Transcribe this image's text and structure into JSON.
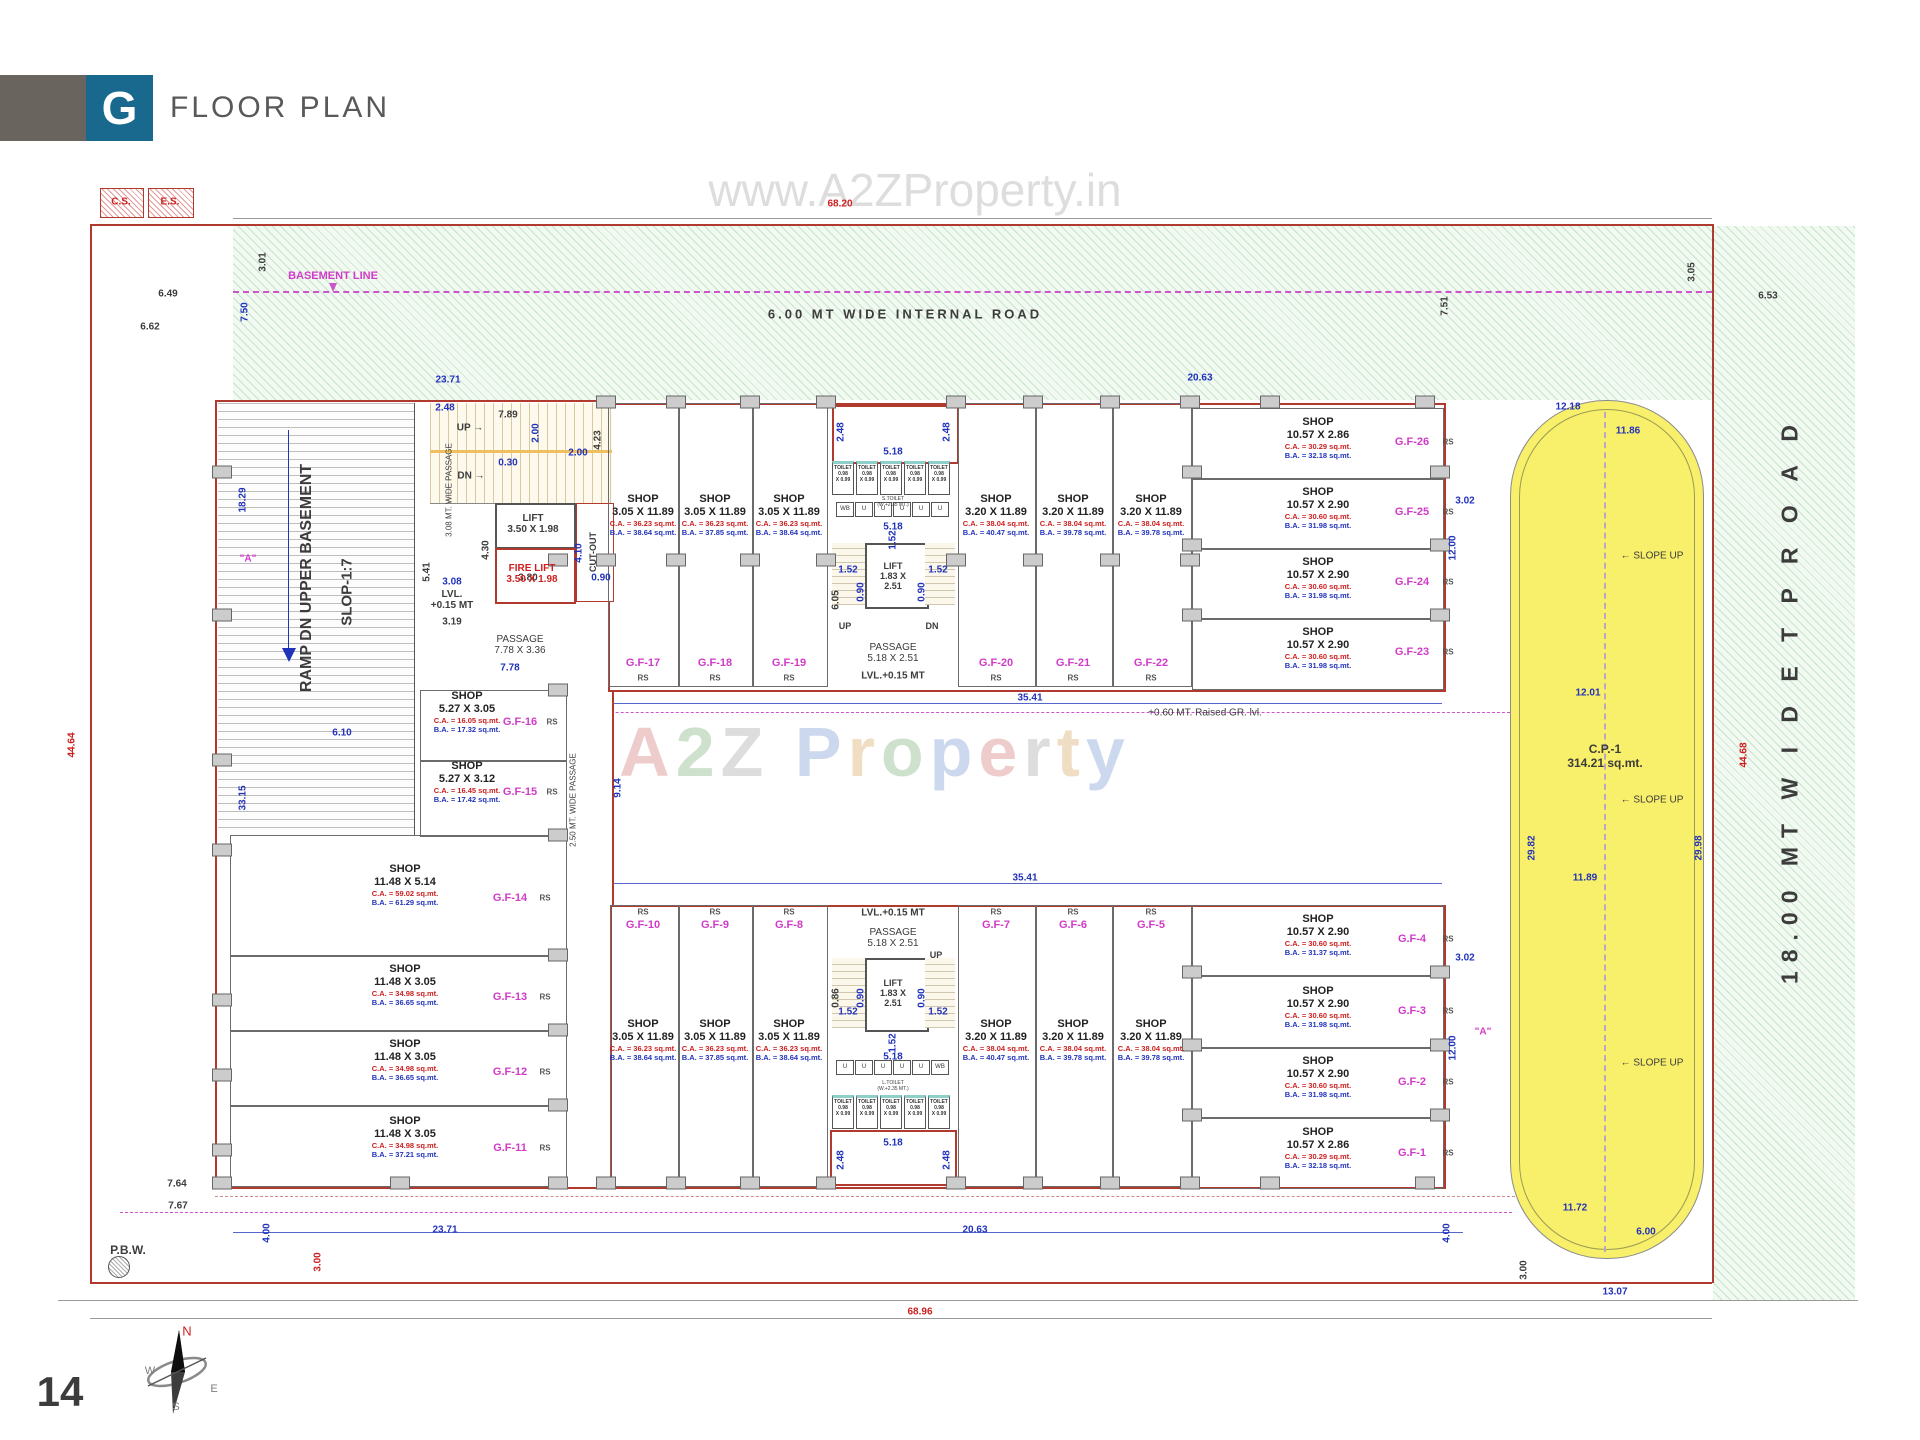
{
  "header": {
    "logo_letter": "G",
    "title": "FLOOR PLAN"
  },
  "page_number": "14",
  "watermarks": {
    "top": "www.A2ZProperty.in",
    "center": "A2Z Property"
  },
  "colors": {
    "accent_teal": "#19688e",
    "boundary_red": "#b03a2e",
    "dim_blue": "#2233bb",
    "dim_red": "#cc2020",
    "shop_id_magenta": "#d03cc8",
    "parking_yellow": "#f8ef6a"
  },
  "cores": {
    "toilet_lines": [
      "TOILET",
      "0.98",
      "X 0.99"
    ],
    "urinals_top": [
      "WB",
      "U",
      "U",
      "U",
      "U",
      "U"
    ],
    "urinals_bottom": [
      "U",
      "U",
      "U",
      "U",
      "U",
      "WB"
    ]
  },
  "shops": [
    {
      "id": "G.F-1",
      "label": "SHOP",
      "size": "10.57 X 2.86",
      "ca": "C.A. = 30.29 sq.mt.",
      "ba": "B.A. = 32.18 sq.mt.",
      "rs": "RS"
    },
    {
      "id": "G.F-2",
      "label": "SHOP",
      "size": "10.57 X 2.90",
      "ca": "C.A. = 30.60 sq.mt.",
      "ba": "B.A. = 31.98 sq.mt.",
      "rs": "RS"
    },
    {
      "id": "G.F-3",
      "label": "SHOP",
      "size": "10.57 X 2.90",
      "ca": "C.A. = 30.60 sq.mt.",
      "ba": "B.A. = 31.98 sq.mt.",
      "rs": "RS"
    },
    {
      "id": "G.F-4",
      "label": "SHOP",
      "size": "10.57 X 2.90",
      "ca": "C.A. = 30.60 sq.mt.",
      "ba": "B.A. = 31.37 sq.mt.",
      "rs": "RS"
    },
    {
      "id": "G.F-5",
      "label": "SHOP",
      "size": "3.20 X 11.89",
      "ca": "C.A. = 38.04 sq.mt.",
      "ba": "B.A. = 39.78 sq.mt.",
      "rs": "RS"
    },
    {
      "id": "G.F-6",
      "label": "SHOP",
      "size": "3.20 X 11.89",
      "ca": "C.A. = 38.04 sq.mt.",
      "ba": "B.A. = 39.78 sq.mt.",
      "rs": "RS"
    },
    {
      "id": "G.F-7",
      "label": "SHOP",
      "size": "3.20 X 11.89",
      "ca": "C.A. = 38.04 sq.mt.",
      "ba": "B.A. = 40.47 sq.mt.",
      "rs": "RS"
    },
    {
      "id": "G.F-8",
      "label": "SHOP",
      "size": "3.05 X 11.89",
      "ca": "C.A. = 36.23 sq.mt.",
      "ba": "B.A. = 38.64 sq.mt.",
      "rs": "RS"
    },
    {
      "id": "G.F-9",
      "label": "SHOP",
      "size": "3.05 X 11.89",
      "ca": "C.A. = 36.23 sq.mt.",
      "ba": "B.A. = 37.85 sq.mt.",
      "rs": "RS"
    },
    {
      "id": "G.F-10",
      "label": "SHOP",
      "size": "3.05 X 11.89",
      "ca": "C.A. = 36.23 sq.mt.",
      "ba": "B.A. = 38.64 sq.mt.",
      "rs": "RS"
    },
    {
      "id": "G.F-11",
      "label": "SHOP",
      "size": "11.48 X 3.05",
      "ca": "C.A. = 34.98 sq.mt.",
      "ba": "B.A. = 37.21 sq.mt.",
      "rs": "RS"
    },
    {
      "id": "G.F-12",
      "label": "SHOP",
      "size": "11.48 X 3.05",
      "ca": "C.A. = 34.98 sq.mt.",
      "ba": "B.A. = 36.65 sq.mt.",
      "rs": "RS"
    },
    {
      "id": "G.F-13",
      "label": "SHOP",
      "size": "11.48 X 3.05",
      "ca": "C.A. = 34.98 sq.mt.",
      "ba": "B.A. = 36.65 sq.mt.",
      "rs": "RS"
    },
    {
      "id": "G.F-14",
      "label": "SHOP",
      "size": "11.48 X 5.14",
      "ca": "C.A. = 59.02 sq.mt.",
      "ba": "B.A. = 61.29 sq.mt.",
      "rs": "RS"
    },
    {
      "id": "G.F-15",
      "label": "SHOP",
      "size": "5.27 X 3.12",
      "ca": "C.A. = 16.45 sq.mt.",
      "ba": "B.A. = 17.42 sq.mt.",
      "rs": "RS"
    },
    {
      "id": "G.F-16",
      "label": "SHOP",
      "size": "5.27 X 3.05",
      "ca": "C.A. = 16.05 sq.mt.",
      "ba": "B.A. = 17.32 sq.mt.",
      "rs": "RS"
    },
    {
      "id": "G.F-17",
      "label": "SHOP",
      "size": "3.05 X 11.89",
      "ca": "C.A. = 36.23 sq.mt.",
      "ba": "B.A. = 38.64 sq.mt.",
      "rs": "RS"
    },
    {
      "id": "G.F-18",
      "label": "SHOP",
      "size": "3.05 X 11.89",
      "ca": "C.A. = 36.23 sq.mt.",
      "ba": "B.A. = 37.85 sq.mt.",
      "rs": "RS"
    },
    {
      "id": "G.F-19",
      "label": "SHOP",
      "size": "3.05 X 11.89",
      "ca": "C.A. = 36.23 sq.mt.",
      "ba": "B.A. = 38.64 sq.mt.",
      "rs": "RS"
    },
    {
      "id": "G.F-20",
      "label": "SHOP",
      "size": "3.20 X 11.89",
      "ca": "C.A. = 38.04 sq.mt.",
      "ba": "B.A. = 40.47 sq.mt.",
      "rs": "RS"
    },
    {
      "id": "G.F-21",
      "label": "SHOP",
      "size": "3.20 X 11.89",
      "ca": "C.A. = 38.04 sq.mt.",
      "ba": "B.A. = 39.78 sq.mt.",
      "rs": "RS"
    },
    {
      "id": "G.F-22",
      "label": "SHOP",
      "size": "3.20 X 11.89",
      "ca": "C.A. = 38.04 sq.mt.",
      "ba": "B.A. = 39.78 sq.mt.",
      "rs": "RS"
    },
    {
      "id": "G.F-23",
      "label": "SHOP",
      "size": "10.57 X 2.90",
      "ca": "C.A. = 30.60 sq.mt.",
      "ba": "B.A. = 31.98 sq.mt.",
      "rs": "RS"
    },
    {
      "id": "G.F-24",
      "label": "SHOP",
      "size": "10.57 X 2.90",
      "ca": "C.A. = 30.60 sq.mt.",
      "ba": "B.A. = 31.98 sq.mt.",
      "rs": "RS"
    },
    {
      "id": "G.F-25",
      "label": "SHOP",
      "size": "10.57 X 2.90",
      "ca": "C.A. = 30.60 sq.mt.",
      "ba": "B.A. = 31.98 sq.mt.",
      "rs": "RS"
    },
    {
      "id": "G.F-26",
      "label": "SHOP",
      "size": "10.57 X 2.86",
      "ca": "C.A. = 30.29 sq.mt.",
      "ba": "B.A. = 32.18 sq.mt.",
      "rs": "RS"
    }
  ],
  "annotations": [
    {
      "t": "68.20",
      "x": 840,
      "y": 204,
      "c": "r"
    },
    {
      "t": "23.71",
      "x": 448,
      "y": 380,
      "c": "b"
    },
    {
      "t": "20.63",
      "x": 1200,
      "y": 378,
      "c": "b"
    },
    {
      "t": "6.49",
      "x": 168,
      "y": 294,
      "c": "k"
    },
    {
      "t": "6.62",
      "x": 150,
      "y": 327,
      "c": "k"
    },
    {
      "t": "3.01",
      "x": 263,
      "y": 262,
      "c": "k",
      "v": 1
    },
    {
      "t": "7.50",
      "x": 245,
      "y": 312,
      "c": "b",
      "v": 1
    },
    {
      "t": "3.05",
      "x": 1692,
      "y": 272,
      "c": "k",
      "v": 1
    },
    {
      "t": "7.51",
      "x": 1445,
      "y": 306,
      "c": "k",
      "v": 1
    },
    {
      "t": "6.53",
      "x": 1768,
      "y": 296,
      "c": "k"
    },
    {
      "t": "12.18",
      "x": 1568,
      "y": 407,
      "c": "b"
    },
    {
      "t": "11.86",
      "x": 1628,
      "y": 431,
      "c": "b"
    },
    {
      "t": "3.02",
      "x": 1465,
      "y": 501,
      "c": "b"
    },
    {
      "t": "12.00",
      "x": 1453,
      "y": 548,
      "c": "b",
      "v": 1
    },
    {
      "t": "12.01",
      "x": 1588,
      "y": 693,
      "c": "b"
    },
    {
      "t": "29.82",
      "x": 1532,
      "y": 848,
      "c": "b",
      "v": 1
    },
    {
      "t": "29.98",
      "x": 1699,
      "y": 848,
      "c": "b",
      "v": 1
    },
    {
      "t": "11.89",
      "x": 1585,
      "y": 878,
      "c": "b"
    },
    {
      "t": "3.02",
      "x": 1465,
      "y": 958,
      "c": "b"
    },
    {
      "t": "12.00",
      "x": 1453,
      "y": 1048,
      "c": "b",
      "v": 1
    },
    {
      "t": "11.72",
      "x": 1575,
      "y": 1208,
      "c": "b"
    },
    {
      "t": "6.00",
      "x": 1646,
      "y": 1232,
      "c": "b"
    },
    {
      "t": "3.00",
      "x": 1524,
      "y": 1270,
      "c": "k",
      "v": 1
    },
    {
      "t": "13.07",
      "x": 1615,
      "y": 1292,
      "c": "b"
    },
    {
      "t": "44.68",
      "x": 1744,
      "y": 755,
      "c": "r",
      "v": 1
    },
    {
      "t": "44.64",
      "x": 72,
      "y": 745,
      "c": "r",
      "v": 1
    },
    {
      "t": "18.29",
      "x": 243,
      "y": 500,
      "c": "b",
      "v": 1
    },
    {
      "t": "33.15",
      "x": 243,
      "y": 798,
      "c": "b",
      "v": 1
    },
    {
      "t": "6.10",
      "x": 342,
      "y": 733,
      "c": "b"
    },
    {
      "t": "9.14",
      "x": 618,
      "y": 788,
      "c": "b",
      "v": 1
    },
    {
      "t": "35.41",
      "x": 1030,
      "y": 698,
      "c": "b"
    },
    {
      "t": "35.41",
      "x": 1025,
      "y": 878,
      "c": "b"
    },
    {
      "t": "23.71",
      "x": 445,
      "y": 1230,
      "c": "b"
    },
    {
      "t": "20.63",
      "x": 975,
      "y": 1230,
      "c": "b"
    },
    {
      "t": "4.00",
      "x": 267,
      "y": 1233,
      "c": "b",
      "v": 1
    },
    {
      "t": "4.00",
      "x": 1447,
      "y": 1233,
      "c": "b",
      "v": 1
    },
    {
      "t": "3.00",
      "x": 318,
      "y": 1262,
      "c": "r",
      "v": 1
    },
    {
      "t": "7.64",
      "x": 177,
      "y": 1184,
      "c": "k"
    },
    {
      "t": "7.67",
      "x": 178,
      "y": 1206,
      "c": "k"
    },
    {
      "t": "68.96",
      "x": 920,
      "y": 1312,
      "c": "r"
    },
    {
      "t": "2.48",
      "x": 445,
      "y": 408,
      "c": "b"
    },
    {
      "t": "7.89",
      "x": 508,
      "y": 415,
      "c": "k"
    },
    {
      "t": "2.00",
      "x": 536,
      "y": 433,
      "c": "b",
      "v": 1
    },
    {
      "t": "2.00",
      "x": 578,
      "y": 453,
      "c": "b"
    },
    {
      "t": "0.30",
      "x": 508,
      "y": 463,
      "c": "b"
    },
    {
      "t": "4.23",
      "x": 598,
      "y": 440,
      "c": "k",
      "v": 1
    },
    {
      "t": "5.41",
      "x": 427,
      "y": 572,
      "c": "k",
      "v": 1
    },
    {
      "t": "4.30",
      "x": 486,
      "y": 550,
      "c": "k",
      "v": 1
    },
    {
      "t": "3.08",
      "x": 452,
      "y": 582,
      "c": "b"
    },
    {
      "t": "3.80",
      "x": 528,
      "y": 578,
      "c": "k"
    },
    {
      "t": "0.90",
      "x": 601,
      "y": 578,
      "c": "b"
    },
    {
      "t": "4.10",
      "x": 579,
      "y": 553,
      "c": "b",
      "v": 1
    },
    {
      "t": "3.19",
      "x": 452,
      "y": 622,
      "c": "k"
    },
    {
      "t": "7.78",
      "x": 510,
      "y": 668,
      "c": "b"
    },
    {
      "t": "2.48",
      "x": 841,
      "y": 432,
      "c": "b",
      "v": 1
    },
    {
      "t": "2.48",
      "x": 947,
      "y": 432,
      "c": "b",
      "v": 1
    },
    {
      "t": "5.18",
      "x": 893,
      "y": 452,
      "c": "b"
    },
    {
      "t": "5.18",
      "x": 893,
      "y": 527,
      "c": "b"
    },
    {
      "t": "1.52",
      "x": 893,
      "y": 540,
      "c": "b",
      "v": 1
    },
    {
      "t": "1.52",
      "x": 848,
      "y": 570,
      "c": "b"
    },
    {
      "t": "1.52",
      "x": 938,
      "y": 570,
      "c": "b"
    },
    {
      "t": "0.90",
      "x": 861,
      "y": 592,
      "c": "b",
      "v": 1
    },
    {
      "t": "0.90",
      "x": 922,
      "y": 592,
      "c": "b",
      "v": 1
    },
    {
      "t": "6.05",
      "x": 836,
      "y": 600,
      "c": "k",
      "v": 1
    },
    {
      "t": "1.52",
      "x": 848,
      "y": 1012,
      "c": "b"
    },
    {
      "t": "1.52",
      "x": 938,
      "y": 1012,
      "c": "b"
    },
    {
      "t": "0.90",
      "x": 861,
      "y": 998,
      "c": "b",
      "v": 1
    },
    {
      "t": "0.90",
      "x": 922,
      "y": 998,
      "c": "b",
      "v": 1
    },
    {
      "t": "0.86",
      "x": 836,
      "y": 998,
      "c": "k",
      "v": 1
    },
    {
      "t": "1.52",
      "x": 893,
      "y": 1043,
      "c": "b",
      "v": 1
    },
    {
      "t": "5.18",
      "x": 893,
      "y": 1057,
      "c": "b"
    },
    {
      "t": "5.18",
      "x": 893,
      "y": 1143,
      "c": "b"
    },
    {
      "t": "2.48",
      "x": 841,
      "y": 1160,
      "c": "b",
      "v": 1
    },
    {
      "t": "2.48",
      "x": 947,
      "y": 1160,
      "c": "b",
      "v": 1
    }
  ],
  "texts": [
    {
      "t": "BASEMENT LINE",
      "x": 333,
      "y": 276,
      "s": 11,
      "c": "m",
      "b": 1
    },
    {
      "t": "6.00 MT  WIDE  INTERNAL  ROAD",
      "x": 905,
      "y": 314,
      "s": 13,
      "c": "k",
      "b": 1,
      "ls": 3
    },
    {
      "t": "RAMP DN UPPER BASEMENT",
      "x": 307,
      "y": 578,
      "s": 16,
      "c": "k",
      "b": 1,
      "v": 1
    },
    {
      "t": "SLOP-1:7",
      "x": 347,
      "y": 592,
      "s": 15,
      "c": "k",
      "b": 1,
      "v": 1
    },
    {
      "t": "3.08 MT. WIDE PASSAGE",
      "x": 449,
      "y": 490,
      "s": 8,
      "c": "k",
      "v": 1
    },
    {
      "t": "2.50 MT. WIDE PASSAGE",
      "x": 573,
      "y": 800,
      "s": 8,
      "c": "k",
      "v": 1
    },
    {
      "t": "UP →",
      "x": 470,
      "y": 428,
      "s": 10,
      "c": "k",
      "b": 1
    },
    {
      "t": "DN →",
      "x": 471,
      "y": 476,
      "s": 10,
      "c": "k",
      "b": 1
    },
    {
      "t": "LIFT\n3.50 X 1.98",
      "x": 533,
      "y": 524,
      "s": 10,
      "c": "k",
      "b": 1,
      "p": 1
    },
    {
      "t": "FIRE LIFT\n3.50 X 1.98",
      "x": 532,
      "y": 574,
      "s": 10,
      "c": "r",
      "b": 1,
      "p": 1
    },
    {
      "t": "CUT-OUT",
      "x": 593,
      "y": 552,
      "s": 9,
      "c": "k",
      "b": 1,
      "v": 1
    },
    {
      "t": "LVL.\n+0.15 MT",
      "x": 452,
      "y": 600,
      "s": 10,
      "c": "k",
      "b": 1,
      "p": 1
    },
    {
      "t": "PASSAGE\n7.78 X 3.36",
      "x": 520,
      "y": 645,
      "s": 10,
      "c": "k",
      "p": 1
    },
    {
      "t": "S.TOILET\n(W.+2.35 MT.)",
      "x": 893,
      "y": 502,
      "s": 5,
      "c": "k",
      "p": 1
    },
    {
      "t": "PASSAGE\n5.18 X 2.51",
      "x": 893,
      "y": 653,
      "s": 10,
      "c": "k",
      "p": 1
    },
    {
      "t": "LVL.+0.15 MT",
      "x": 893,
      "y": 676,
      "s": 10,
      "c": "k",
      "b": 1
    },
    {
      "t": "UP",
      "x": 845,
      "y": 626,
      "s": 9,
      "c": "k",
      "b": 1
    },
    {
      "t": "DN",
      "x": 932,
      "y": 626,
      "s": 9,
      "c": "k",
      "b": 1
    },
    {
      "t": "LIFT\n1.83 X\n2.51",
      "x": 893,
      "y": 576,
      "s": 9,
      "c": "k",
      "b": 1,
      "p": 1
    },
    {
      "t": "LVL.+0.15 MT",
      "x": 893,
      "y": 913,
      "s": 10,
      "c": "k",
      "b": 1
    },
    {
      "t": "PASSAGE\n5.18 X 2.51",
      "x": 893,
      "y": 938,
      "s": 10,
      "c": "k",
      "p": 1
    },
    {
      "t": "LIFT\n1.83 X\n2.51",
      "x": 893,
      "y": 993,
      "s": 9,
      "c": "k",
      "b": 1,
      "p": 1
    },
    {
      "t": "UP",
      "x": 936,
      "y": 955,
      "s": 9,
      "c": "k",
      "b": 1
    },
    {
      "t": "L.TOILET\n(W.+2.35 MT.)",
      "x": 893,
      "y": 1086,
      "s": 5,
      "c": "k",
      "p": 1
    },
    {
      "t": "C.P.-1\n314.21 sq.mt.",
      "x": 1605,
      "y": 756,
      "s": 12,
      "c": "k",
      "b": 1,
      "p": 1
    },
    {
      "t": "←  SLOPE UP",
      "x": 1652,
      "y": 556,
      "s": 10,
      "c": "k"
    },
    {
      "t": "←  SLOPE UP",
      "x": 1652,
      "y": 800,
      "s": 10,
      "c": "k"
    },
    {
      "t": "←  SLOPE UP",
      "x": 1652,
      "y": 1063,
      "s": 10,
      "c": "k"
    },
    {
      "t": "+0.60 MT. Raised GR. lvl.",
      "x": 1205,
      "y": 713,
      "s": 10,
      "c": "k"
    },
    {
      "t": "P.B.W.",
      "x": 128,
      "y": 1250,
      "s": 12,
      "c": "k",
      "b": 1
    },
    {
      "t": "\"A\"",
      "x": 248,
      "y": 559,
      "s": 10,
      "c": "m",
      "b": 1
    },
    {
      "t": "\"A\"",
      "x": 1483,
      "y": 1032,
      "s": 10,
      "c": "m",
      "b": 1
    },
    {
      "t": "18.00 MT   W I D E   T P   R O A D",
      "x": 1790,
      "y": 700,
      "s": 23,
      "c": "k",
      "b": 1,
      "v": 1,
      "ls": 9
    },
    {
      "t": "C.S.",
      "x": 121,
      "y": 202,
      "s": 10,
      "c": "r",
      "b": 1
    },
    {
      "t": "E.S.",
      "x": 170,
      "y": 202,
      "s": 10,
      "c": "r",
      "b": 1
    },
    {
      "t": "N",
      "x": 187,
      "y": 1331,
      "s": 13,
      "c": "r"
    },
    {
      "t": "W",
      "x": 150,
      "y": 1371,
      "s": 11,
      "c": "g"
    },
    {
      "t": "E",
      "x": 214,
      "y": 1389,
      "s": 11,
      "c": "g"
    },
    {
      "t": "S",
      "x": 176,
      "y": 1407,
      "s": 11,
      "c": "g"
    },
    {
      "t": "14",
      "x": 60,
      "y": 1392,
      "s": 42,
      "c": "k",
      "b": 1
    }
  ]
}
